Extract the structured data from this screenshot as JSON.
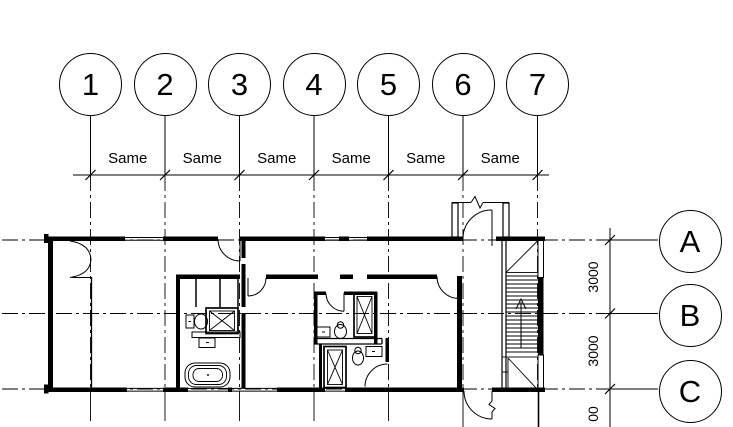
{
  "column_grid": {
    "bubbles": [
      "1",
      "2",
      "3",
      "4",
      "5",
      "6",
      "7"
    ],
    "spacing_labels": [
      "Same",
      "Same",
      "Same",
      "Same",
      "Same",
      "Same"
    ]
  },
  "row_grid": {
    "bubbles": [
      "A",
      "B",
      "C"
    ],
    "dimension_labels": [
      "3000",
      "3000",
      "00"
    ]
  },
  "colors": {
    "line_color": "#000000",
    "background": "#ffffff"
  }
}
